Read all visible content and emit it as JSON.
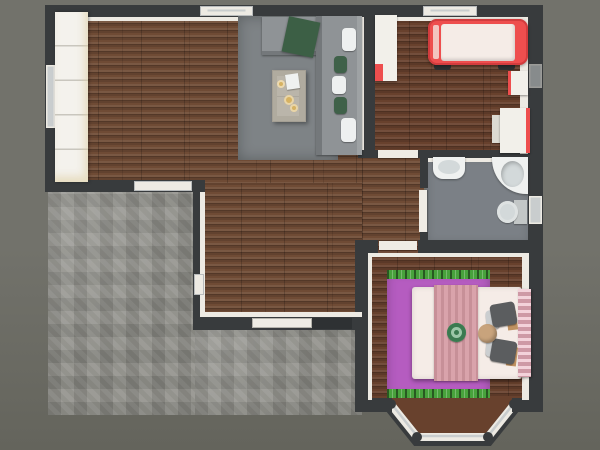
{
  "scene": {
    "kind": "3d-floorplan-top-down-render",
    "rooms": [
      {
        "name": "living-room",
        "floor": "dark-wood-planks"
      },
      {
        "name": "kids-bedroom",
        "floor": "dark-wood-planks"
      },
      {
        "name": "bathroom",
        "floor": "gray"
      },
      {
        "name": "master-bedroom",
        "floor": "dark-wood-planks",
        "feature": "bay-window"
      },
      {
        "name": "hallway",
        "floor": "dark-wood-planks"
      },
      {
        "name": "patio-terrace",
        "floor": "gray-stone-tile"
      }
    ],
    "furniture": {
      "living-room": [
        "white-bookshelf",
        "gray-area-rug",
        "gray-sectional-sofa",
        "green-throw-blanket",
        "white-pillows",
        "green-pillows",
        "beige-coffee-table",
        "gold-plates",
        "white-tray"
      ],
      "kids-bedroom": [
        "white-wardrobe",
        "red-race-car-bed",
        "white-nightstand",
        "white-desk",
        "desk-chair"
      ],
      "bathroom": [
        "sink",
        "corner-bathtub",
        "toilet",
        "open-door"
      ],
      "master-bedroom": [
        "magenta-rug-with-green-fringe",
        "double-bed",
        "pink-blanket",
        "pink-tufted-headboard",
        "gray-pillows",
        "round-tan-cushion",
        "green-round-decor"
      ]
    },
    "openings": [
      "top-window-living",
      "top-window-kids",
      "left-wall-window",
      "patio-wall-window",
      "living-west-window",
      "kids-right-window",
      "bathroom-right-window",
      "patio-sliding-door",
      "kids-room-door",
      "bathroom-door",
      "master-bedroom-door",
      "bay-window"
    ]
  },
  "palette": {
    "background1": "#72726b",
    "background2": "#64645c",
    "wall": "#383b3d",
    "wallFace": "#edeae3",
    "wood": "#6f4b35",
    "woodDark": "#68412d",
    "stone": "#8d8c86",
    "rug": "#7e8386",
    "sofa": "#8f9396",
    "sofaBack": "#74787b",
    "pillowWhite": "#eef0f0",
    "pillowGreen": "#3f6149",
    "throwGreen": "#3c5f45",
    "table": "#bab5aa",
    "tableEdge": "#a49f94",
    "gold": "#d6b262",
    "cabinet": "#f4f2ed",
    "red": "#ee4e4e",
    "redDark": "#d23c3e",
    "mattress": "#f5ece7",
    "white": "#f2f0ea",
    "bathFloor": "#7b8086",
    "fixture": "#eff1f0",
    "basin": "#d3d9da",
    "glass": "#c9cdce",
    "magenta": "#b55cc0",
    "grass": "#48a23c",
    "blanketPink": "#d69ba4",
    "headboardPink": "#eaaebc",
    "pillowDark": "#5b5d5f",
    "pillowLight": "#cbced0",
    "tan": "#c8a37c",
    "woodAccent": "#bf9160",
    "decorGreen": "#3b7a50",
    "decorGreenLight": "#9cc7a8",
    "doorWhite": "#efece5"
  }
}
